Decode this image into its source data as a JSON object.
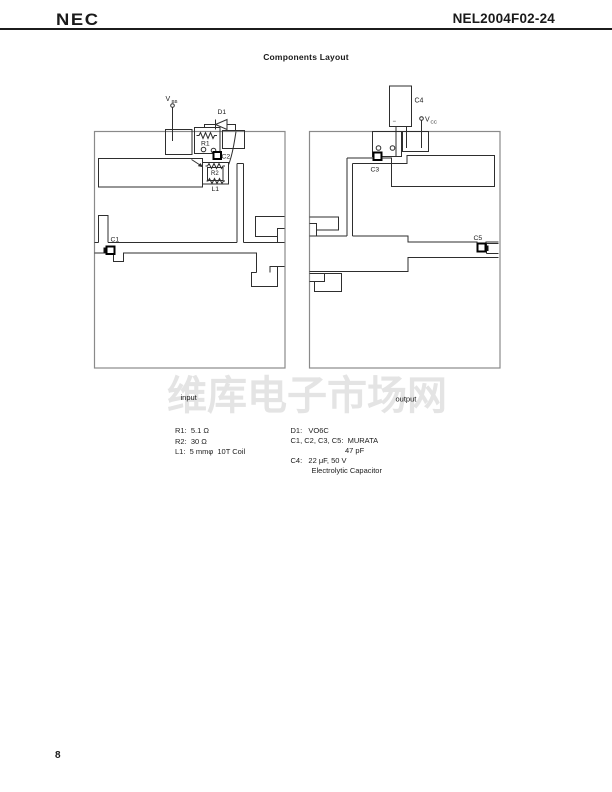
{
  "header": {
    "logo": "NEC",
    "part_number": "NEL2004F02-24"
  },
  "title": "Components Layout",
  "diagram": {
    "left_board": {
      "caption": "input",
      "vbb": {
        "base": "V",
        "sub": "BB"
      },
      "d1": "D1",
      "r1": "R1",
      "c2": "C2",
      "r2": "R2",
      "l1": "L1",
      "c1": "C1"
    },
    "right_board": {
      "caption": "output",
      "vcc": {
        "base": "V",
        "sub": "CC"
      },
      "c4": "C4",
      "c4_polarity": "−",
      "c3": "C3",
      "c5": "C5"
    }
  },
  "parts_list": {
    "left": [
      "R1:  5.1 Ω",
      "R2:  30 Ω",
      "L1:  5 mmφ  10T Coil"
    ],
    "right": [
      "D1:   VO6C",
      "C1, C2, C3, C5:  MURATA",
      "47 pF",
      "C4:   22 μF, 50 V",
      "Electrolytic Capacitor"
    ]
  },
  "watermark": "维库电子市场网",
  "page_number": "8"
}
